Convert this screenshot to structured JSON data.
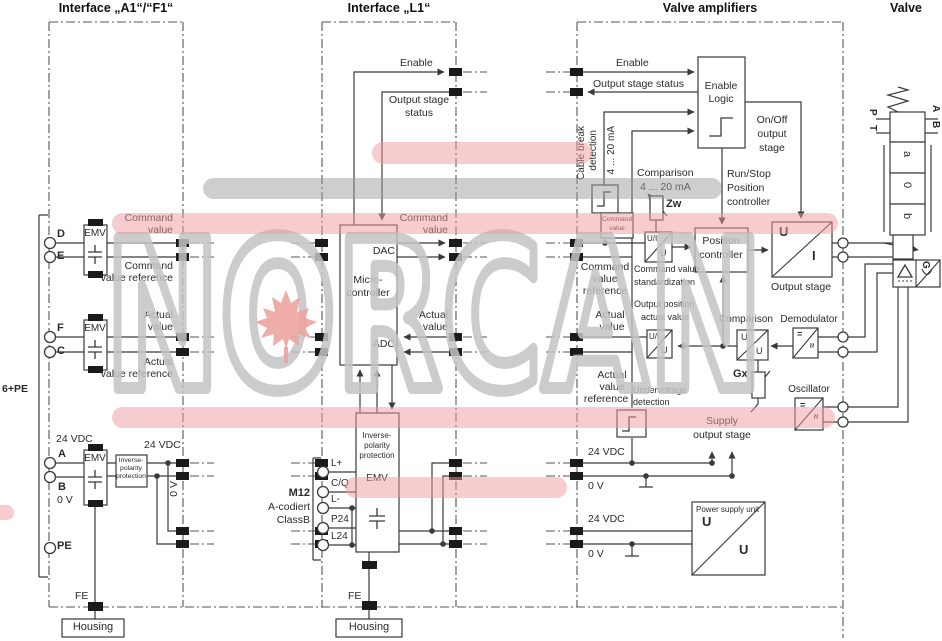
{
  "headers": {
    "a1f1": "Interface „A1“/“F1“",
    "l1": "Interface „L1“",
    "valve_amplifiers": "Valve amplifiers",
    "valve": "Valve"
  },
  "watermark": {
    "text": "NORCAN"
  },
  "colors": {
    "line": "#3a3a3a",
    "highlight_pink": "#ef9aa0",
    "highlight_gray": "#9e9e9e",
    "watermark_gray": "#c4c4c4",
    "leaf_red": "#eca49f"
  },
  "a1f1": {
    "cable": "6+PE",
    "t_d": "D",
    "t_e": "E",
    "t_f": "F",
    "t_c": "C",
    "t_a": "A",
    "t_b": "B",
    "t_pe": "PE",
    "emv": "EMV",
    "cmd1": "Command",
    "cmd2": "value",
    "cmdref1": "Command",
    "cmdref2": "value reference",
    "act1": "Actual",
    "act2": "value",
    "actref1": "Actual",
    "actref2": "value reference",
    "vdc_in": "24 VDC",
    "v0_in": "0 V",
    "inv1": "Inverse-",
    "inv2": "polarity",
    "inv3": "protection",
    "vdc_out": "24 VDC",
    "v0_out": "0 V",
    "fe": "FE",
    "housing": "Housing"
  },
  "l1": {
    "enable": "Enable",
    "oss1": "Output stage",
    "oss2": "status",
    "cmd1": "Command",
    "cmd2": "value",
    "act1": "Actual",
    "act2": "value",
    "dac": "DAC",
    "adc": "ADC",
    "mc1": "Micro-",
    "mc2": "controller",
    "inv1": "Inverse-",
    "inv2": "polarity",
    "inv3": "protection",
    "emv": "EMV",
    "m12": "M12",
    "m12a": "A-codiert",
    "m12b": "ClassB",
    "pin_lp": "L+",
    "pin_cq": "C/Q",
    "pin_lm": "L-",
    "pin_p24": "P24",
    "pin_l24": "L24",
    "fe": "FE",
    "housing": "Housing"
  },
  "va": {
    "enable": "Enable",
    "oss": "Output stage status",
    "el1": "Enable",
    "el2": "Logic",
    "onoff1": "On/Off",
    "onoff2": "output",
    "onoff3": "stage",
    "rs1": "Run/Stop",
    "rs2": "Position",
    "rs3": "controller",
    "cb1": "Cable break",
    "cb2": "detection",
    "cb3": "4 ... 20 mA",
    "tag1": "Command",
    "tag2": "value",
    "comp_zw1": "Comparison",
    "comp_zw2": "4 ... 20 mA",
    "zw": "Zw",
    "cmdref1": "Command",
    "cmdref2": "value",
    "cmdref3": "reference",
    "act1": "Actual",
    "act2": "value",
    "actref1": "Actual",
    "actref2": "value",
    "actref3": "reference",
    "ui": "U/I",
    "u": "U",
    "std1": "Command value",
    "std2": "standardization",
    "pc1": "Position",
    "pc2": "controller",
    "os_u": "U",
    "os_i": "I",
    "os": "Output stage",
    "op1": "Output position",
    "op2": "actual value",
    "comp": "Comparison",
    "gx": "Gx",
    "dem": "Demodulator",
    "osc": "Oscillator",
    "eq": "=",
    "ap": "≈",
    "uv1": "Undervoltage",
    "uv2": "detection",
    "sup1": "Supply",
    "sup2": "output stage",
    "vdc1": "24 VDC",
    "v01": "0 V",
    "vdc2": "24 VDC",
    "v02": "0 V",
    "psu": "Power supply unit",
    "psu_u1": "U",
    "psu_u2": "U"
  },
  "valve": {
    "p": "P",
    "t": "T",
    "a": "A",
    "b": "B",
    "pos_a": "a",
    "pos_0": "0",
    "pos_b": "b",
    "g": "G"
  }
}
